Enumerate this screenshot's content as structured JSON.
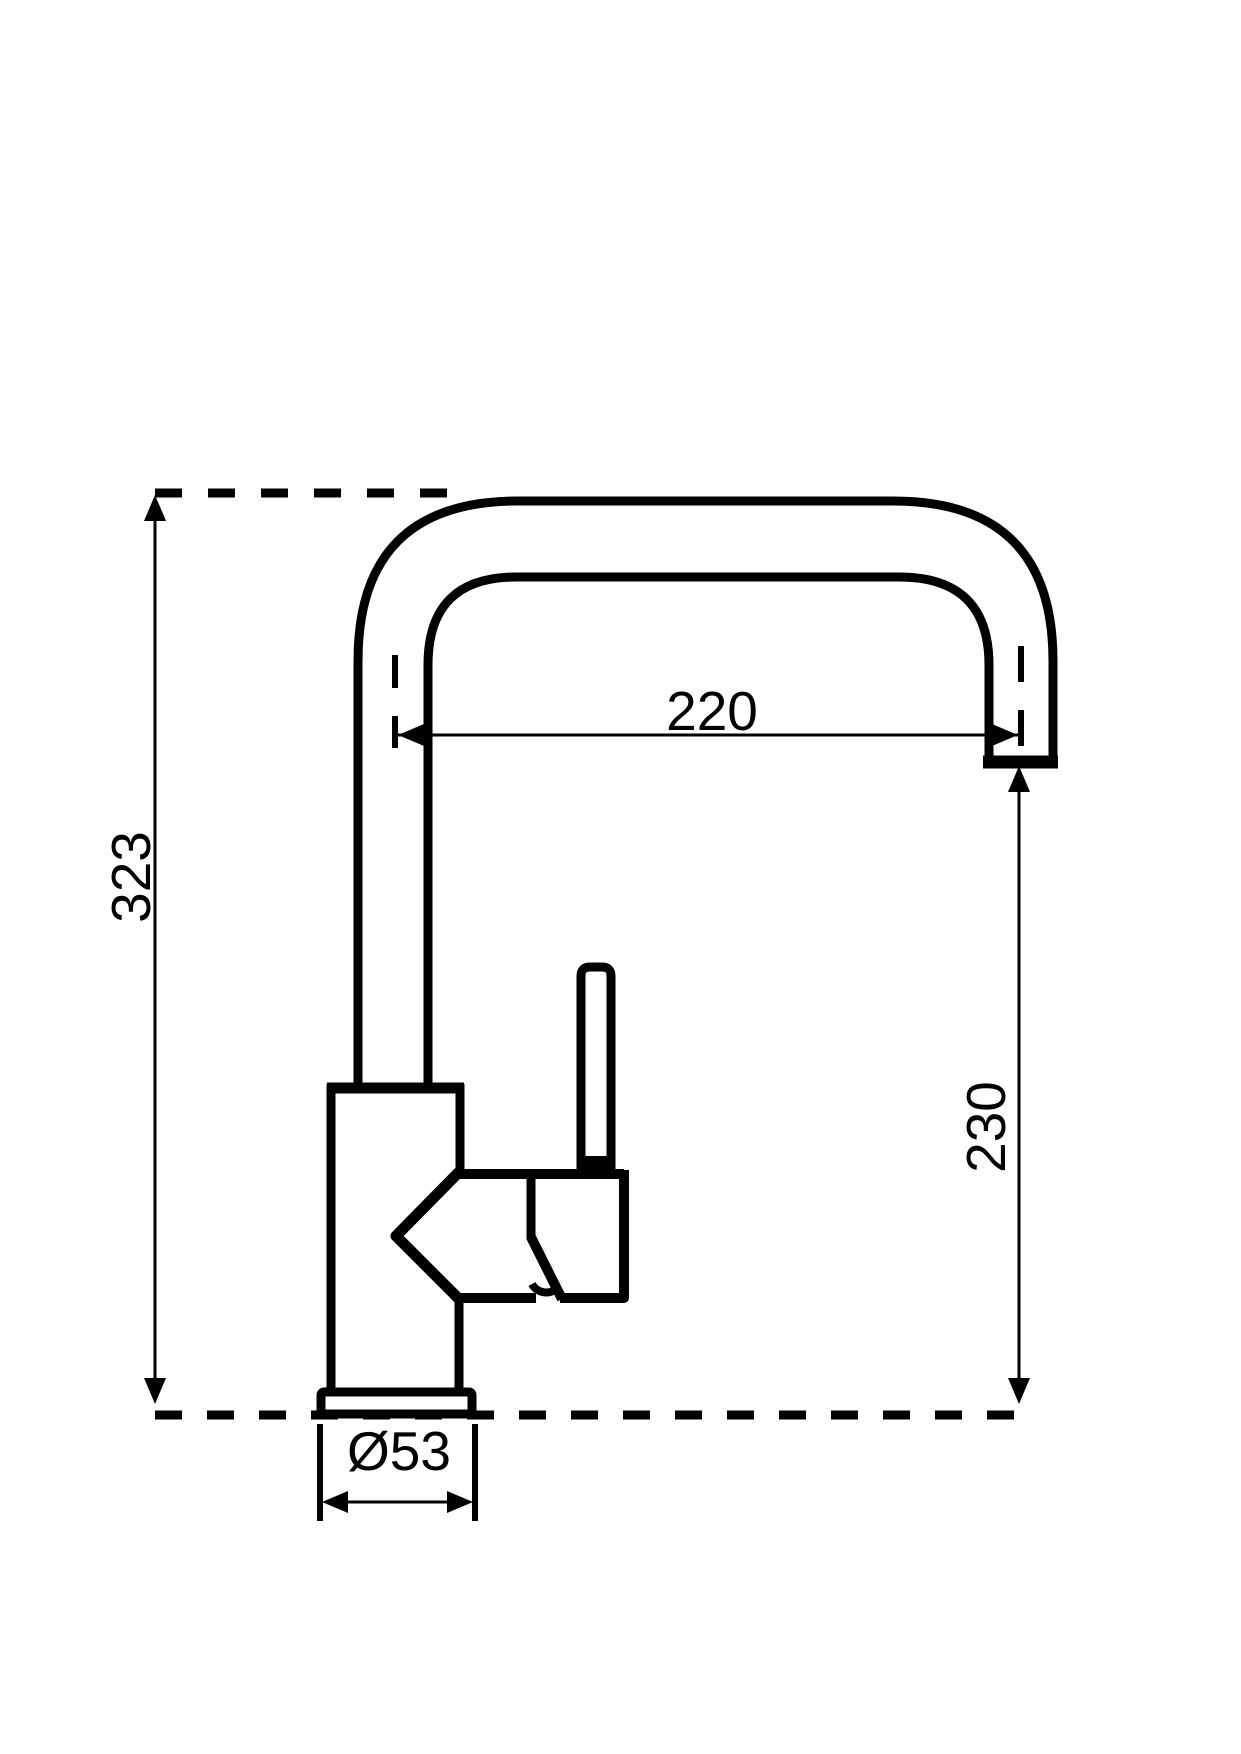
{
  "drawing": {
    "type": "technical-dimension-drawing",
    "subject": "single-lever kitchen mixer faucet with high U-shaped spout, side elevation",
    "background_color": "#ffffff",
    "line_color": "#000000",
    "labels": {
      "total_height": "323",
      "spout_reach": "220",
      "outlet_height": "230",
      "base_diameter": "Ø53"
    }
  }
}
